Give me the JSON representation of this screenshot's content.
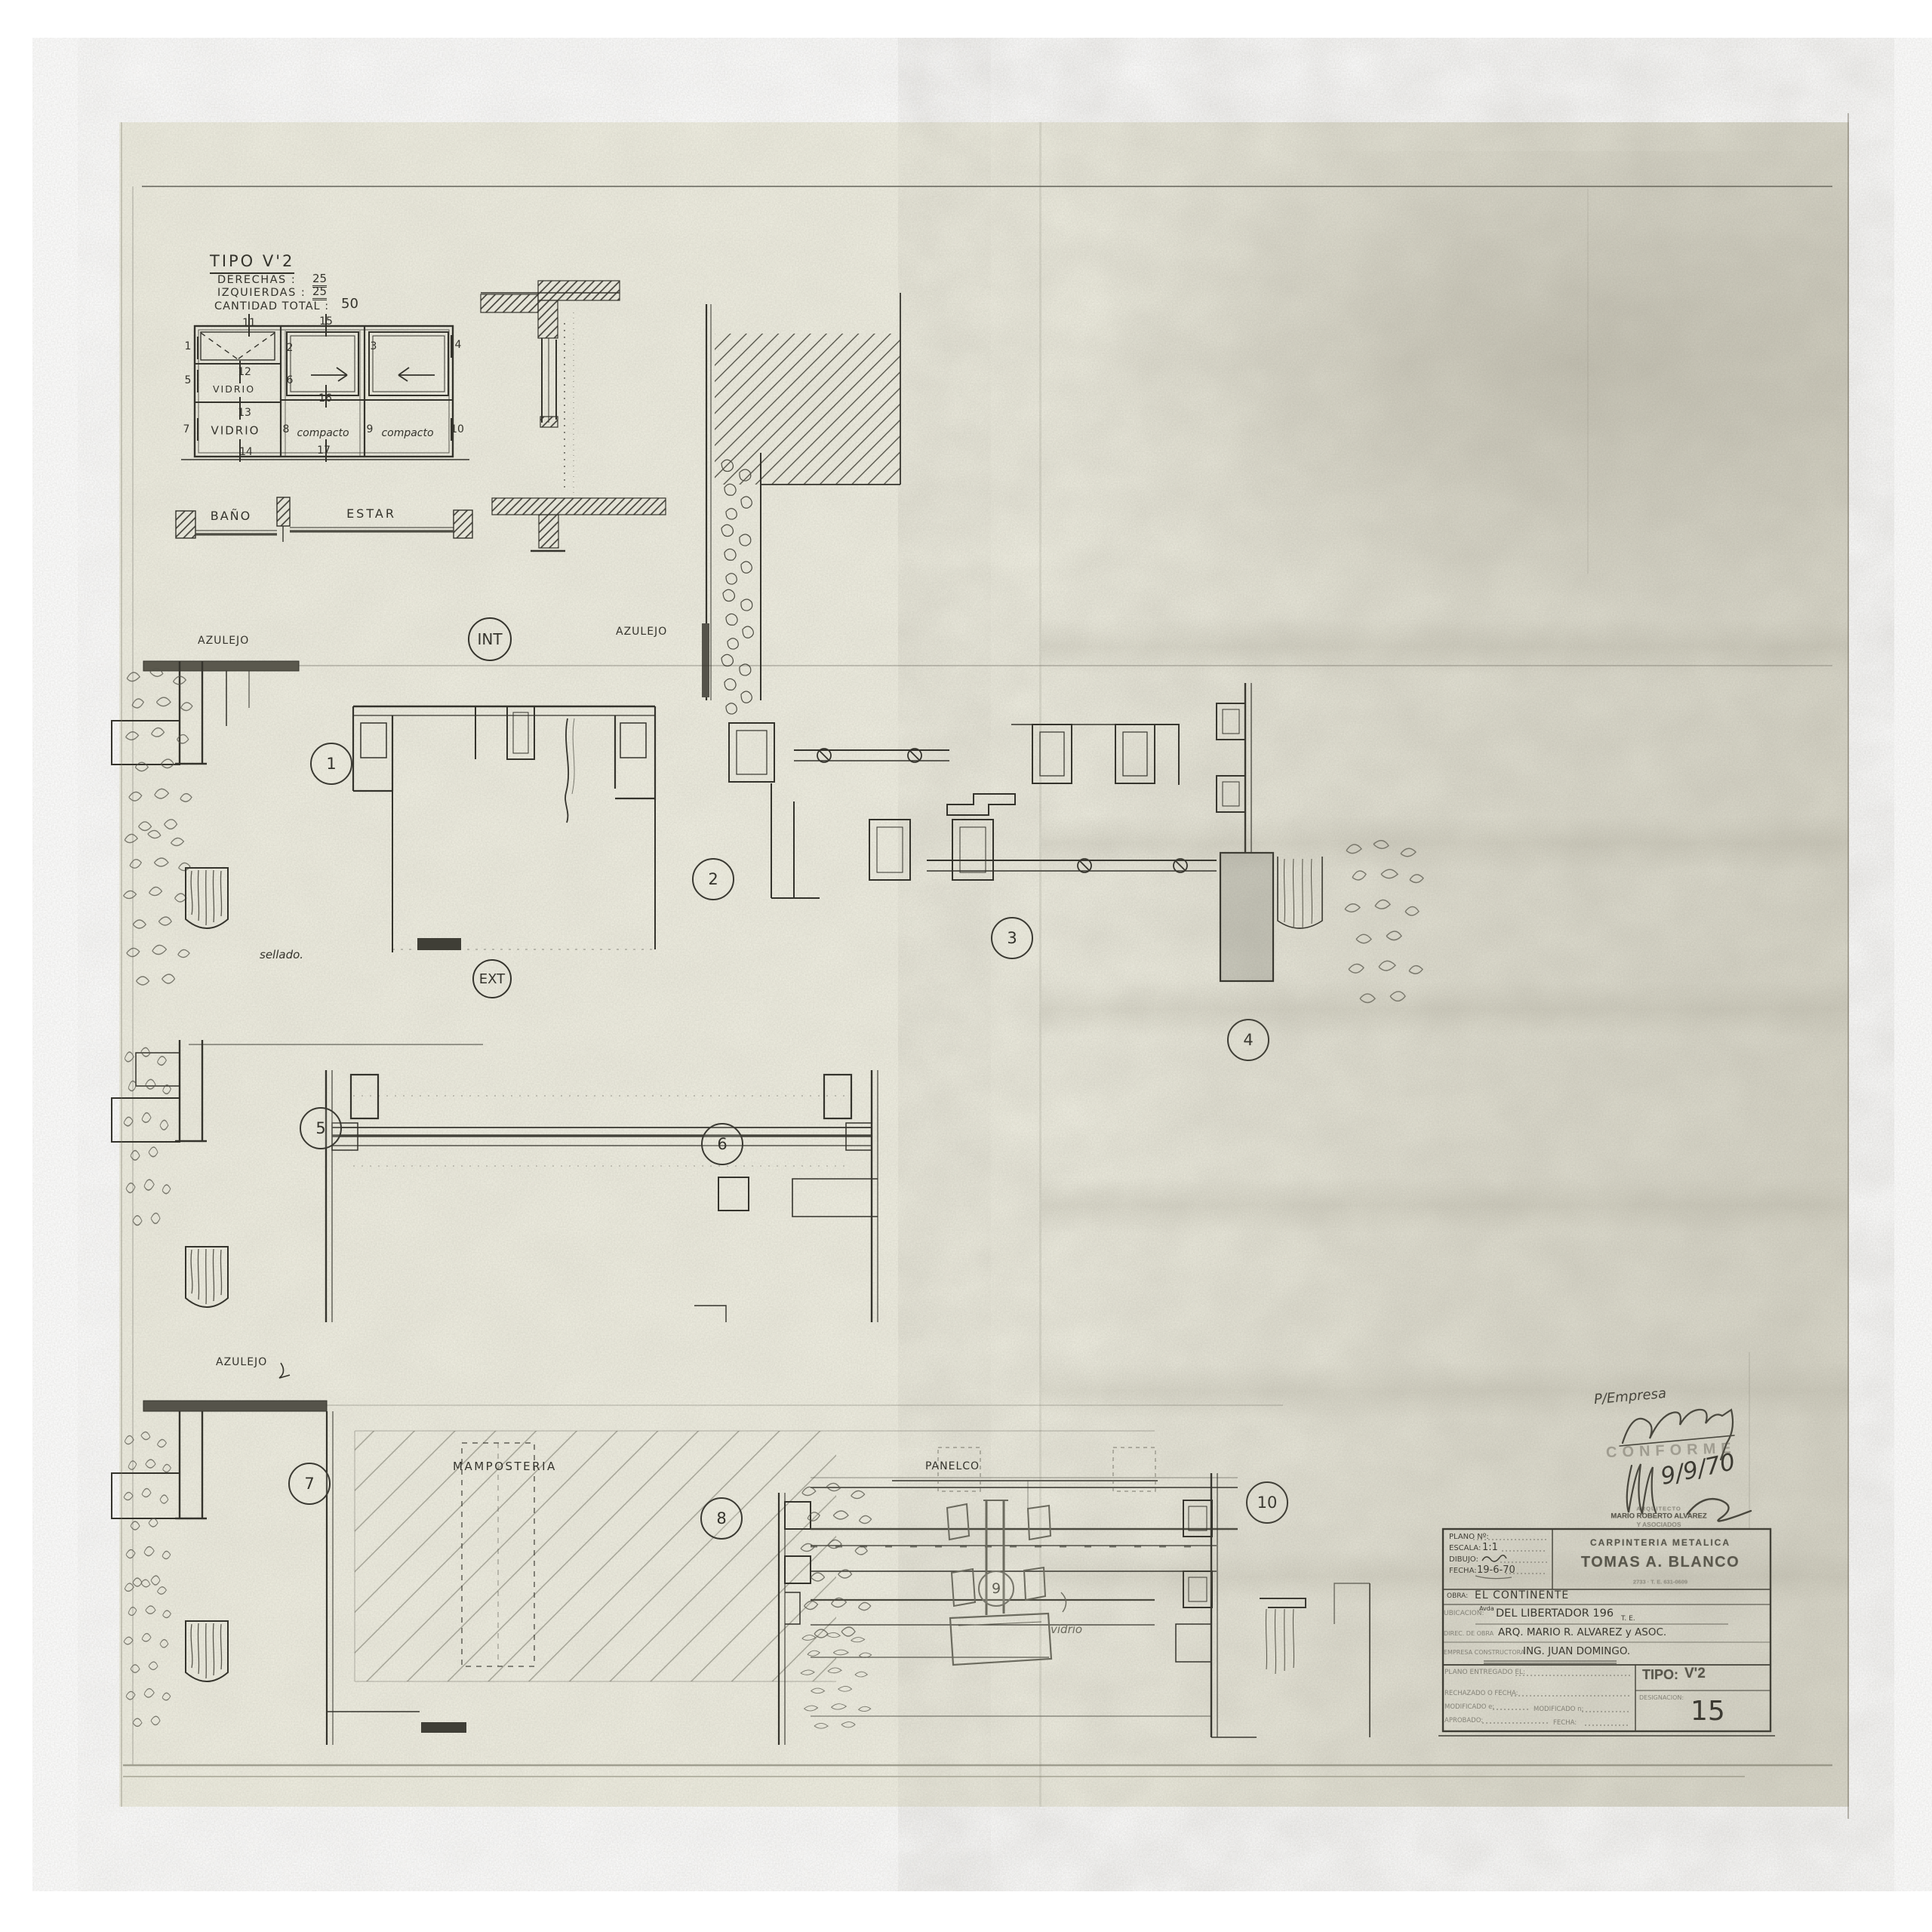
{
  "type_block": {
    "title": "TIPO V'2",
    "rows": [
      {
        "label": "DERECHAS :",
        "value": "25"
      },
      {
        "label": "IZQUIERDAS :",
        "value": "25"
      },
      {
        "label": "CANTIDAD TOTAL :",
        "value": "50"
      }
    ]
  },
  "schematic": {
    "ticks": [
      "1",
      "2",
      "3",
      "4",
      "5",
      "6",
      "7",
      "8",
      "9",
      "10",
      "11",
      "12",
      "13",
      "14",
      "15",
      "16",
      "17"
    ],
    "cells": {
      "top_left": "VIDRIO",
      "bottom_left": "VIDRIO",
      "bottom_mid": "compacto",
      "bottom_right": "compacto"
    },
    "rooms": {
      "left": "BAÑO",
      "right": "ESTAR"
    }
  },
  "plan": {
    "azulejo_left": "AZULEJO",
    "azulejo_right": "AZULEJO",
    "azulejo_bottom": "AZULEJO",
    "int_label": "INT",
    "ext_label": "EXT",
    "sellado": "sellado.",
    "mamposteria": "MAMPOSTERIA",
    "panelco": "PANELCO",
    "vidrio": "vidrio",
    "markers": [
      "1",
      "2",
      "3",
      "4",
      "5",
      "6",
      "7",
      "8",
      "9",
      "10"
    ]
  },
  "approval": {
    "p_empresa": "P/Empresa",
    "conforme": "CONFORME",
    "date": "9/9/70",
    "stamp_line1": "ARQUITECTO",
    "stamp_line2": "MARIO ROBERTO ALVAREZ",
    "stamp_line3": "Y ASOCIADOS"
  },
  "title_block": {
    "plano_no_label": "PLANO Nº:",
    "escala_label": "ESCALA:",
    "escala_value": "1:1",
    "dibujo_label": "DIBUJO:",
    "fecha_label": "FECHA:",
    "fecha_value": "19-6-70",
    "company_line1": "CARPINTERIA METALICA",
    "company_line2": "TOMAS A. BLANCO",
    "company_line3": "2733 ·  T. E. 631-0609",
    "obra_label": "OBRA:",
    "obra_value": "EL CONTINENTE",
    "ubicacion_label": "UBICACION:",
    "ubicacion_sup": "Avda",
    "ubicacion_value": "DEL LIBERTADOR 196",
    "ubicacion_te": "T. E.",
    "direccion_label": "DIREC. DE OBRA",
    "direccion_value": "ARQ. MARIO R. ALVAREZ y ASOC.",
    "constructora_label": "EMPRESA CONSTRUCTORA",
    "constructora_value": "ING. JUAN DOMINGO.",
    "entregado_label": "PLANO ENTREGADO EL:",
    "rechazado_label": "RECHAZADO O FECHA:",
    "modificado1_label": "MODIFICADO e:",
    "modificado2_label": "MODIFICADO n:",
    "aprobado_label": "APROBADO:",
    "fecha2_label": "FECHA:",
    "tipo_label": "TIPO:",
    "tipo_value": "V'2",
    "designacion_label": "DESIGNACION:",
    "sheet_number": "15"
  },
  "colors": {
    "paper": "#f1f0e3",
    "ink": "#34332c",
    "pencil": "#6b6a5e"
  }
}
